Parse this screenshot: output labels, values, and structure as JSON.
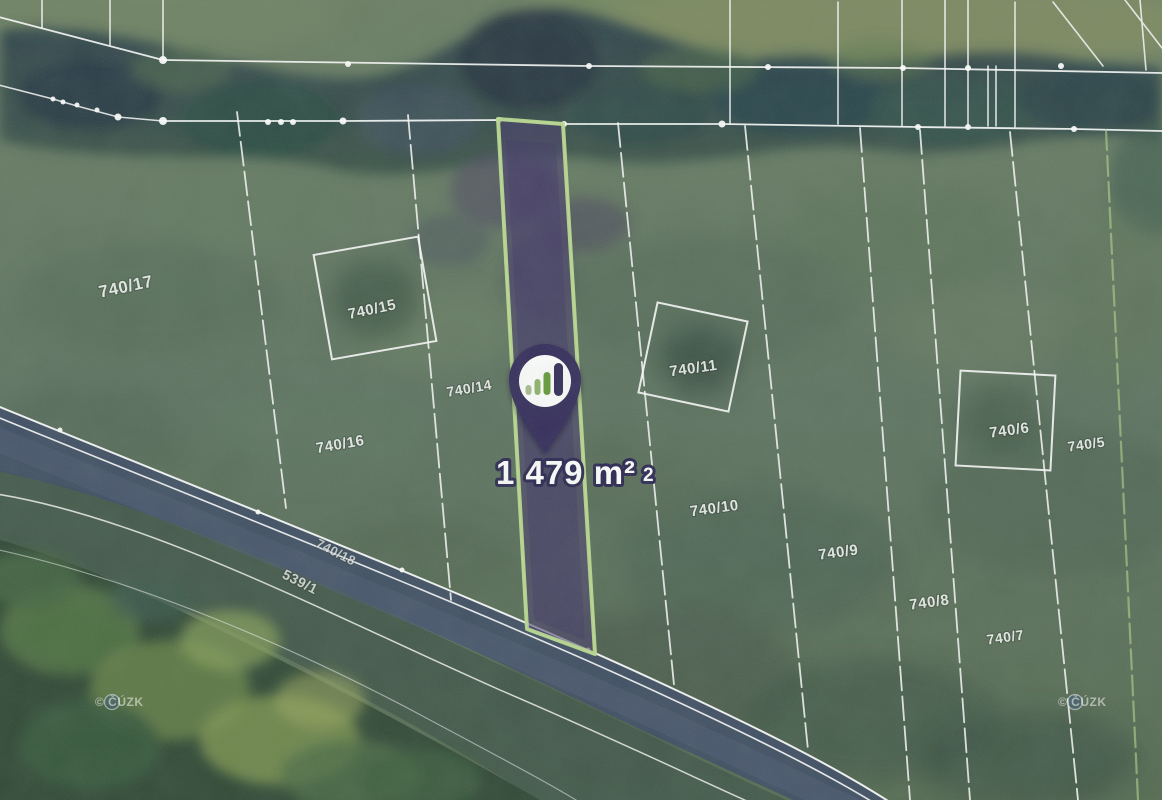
{
  "map": {
    "type": "satellite-cadastral-view",
    "highlighted_parcel": {
      "area_label": "1 479 m²",
      "area_label_suffix": "2",
      "fill_color": "#46396c",
      "border_color": "#bcdb8f"
    },
    "pin": {
      "body_color": "#332a5a",
      "icon": "bar-chart-logo-icon",
      "bar_colors": [
        "#a9bd90",
        "#8fb46b",
        "#649a37",
        "#2e2754"
      ]
    },
    "parcels": [
      {
        "id": "740/17"
      },
      {
        "id": "740/15"
      },
      {
        "id": "740/14"
      },
      {
        "id": "740/16"
      },
      {
        "id": "740/11"
      },
      {
        "id": "740/10"
      },
      {
        "id": "740/9"
      },
      {
        "id": "740/8"
      },
      {
        "id": "740/7"
      },
      {
        "id": "740/6"
      },
      {
        "id": "740/5"
      },
      {
        "id": "740/18"
      },
      {
        "id": "539/1"
      }
    ],
    "watermarks": [
      {
        "text": "© ČÚZK"
      },
      {
        "text": "© ČÚZK"
      }
    ]
  }
}
